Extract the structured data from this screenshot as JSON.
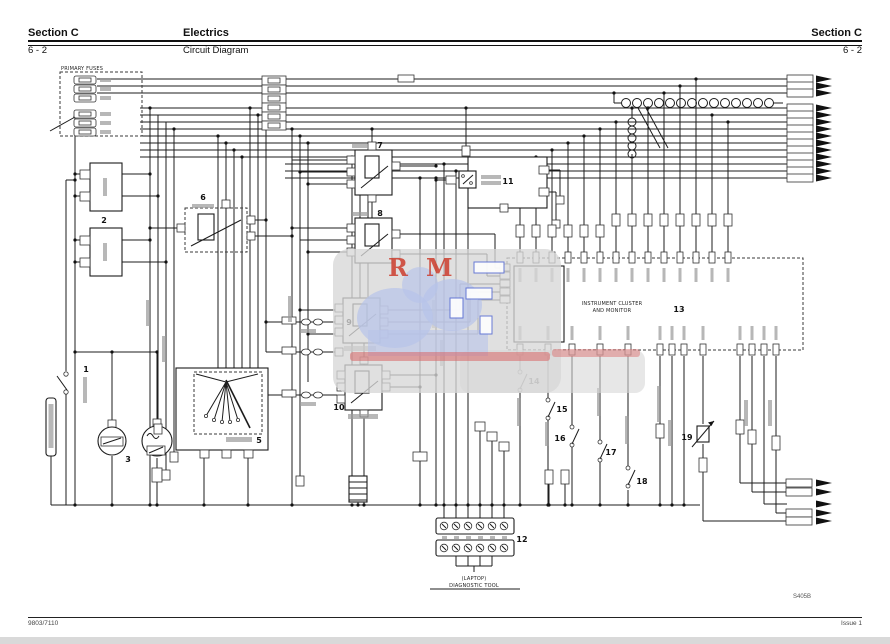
{
  "header": {
    "section_left": "Section C",
    "center_title": "Electrics",
    "section_right": "Section C",
    "page_left": "6 - 2",
    "center_subtitle": "Circuit Diagram",
    "page_right": "6 - 2"
  },
  "footer": {
    "doc_number": "9803/7110",
    "issue": "Issue 1",
    "figure_code": "S405B"
  },
  "watermark": {
    "letter1": "R",
    "letter2": "M"
  },
  "diagram": {
    "labels": {
      "primary_fuses": "PRIMARY FUSES",
      "cluster_line1": "INSTRUMENT CLUSTER",
      "cluster_line2": "AND MONITOR",
      "tool_line1": "(LAPTOP)",
      "tool_line2": "DIAGNOSTIC TOOL"
    },
    "numbers": {
      "n1": "1",
      "n2": "2",
      "n3": "3",
      "n4": "4",
      "n5": "5",
      "n6": "6",
      "n7": "7",
      "n8": "8",
      "n9": "9",
      "n10": "10",
      "n11": "11",
      "n12": "12",
      "n13": "13",
      "n14": "14",
      "n15": "15",
      "n16": "16",
      "n17": "17",
      "n18": "18",
      "n19": "19"
    }
  }
}
